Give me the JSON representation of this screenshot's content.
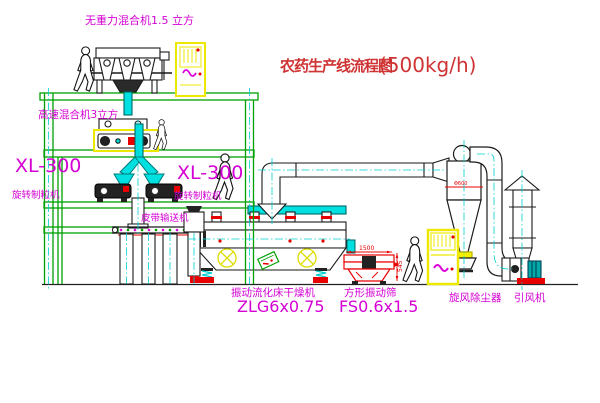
{
  "title": {
    "text": "农药生产线流程图",
    "capacity": "(500kg/h)"
  },
  "equipment": {
    "gravity_mixer": {
      "label": "无重力混合机1.5 立方"
    },
    "high_speed_mixer": {
      "label": "高速混合机3立方"
    },
    "granulator_left": {
      "model": "XL-300",
      "name": "旋转制粒机"
    },
    "granulator_right": {
      "model": "XL-300",
      "name": "旋转制粒机"
    },
    "belt_conveyor": {
      "label": "皮带输送机"
    },
    "dryer": {
      "name": "振动流化床干燥机",
      "model": "ZLG6x0.75"
    },
    "sieve": {
      "name": "方形振动筛",
      "model": "FS0.6x1.5",
      "dim_width": "1500",
      "dim_height": "545"
    },
    "cyclone": {
      "label": "旋风除尘器",
      "dim": "Φ600"
    },
    "fan": {
      "label": "引风机"
    }
  },
  "colors": {
    "structure_green": "#00a000",
    "centerline_cyan": "#00cfcf",
    "pipe_cyan": "#00e0e0",
    "label_magenta": "#d400d4",
    "title_red": "#cf3333",
    "accent_red": "#e80000",
    "cabinet_yellow": "#ede800",
    "symbol_yellow": "#dcdc00",
    "motor_teal": "#00a8a8",
    "linework_black": "#1a1a1a"
  }
}
